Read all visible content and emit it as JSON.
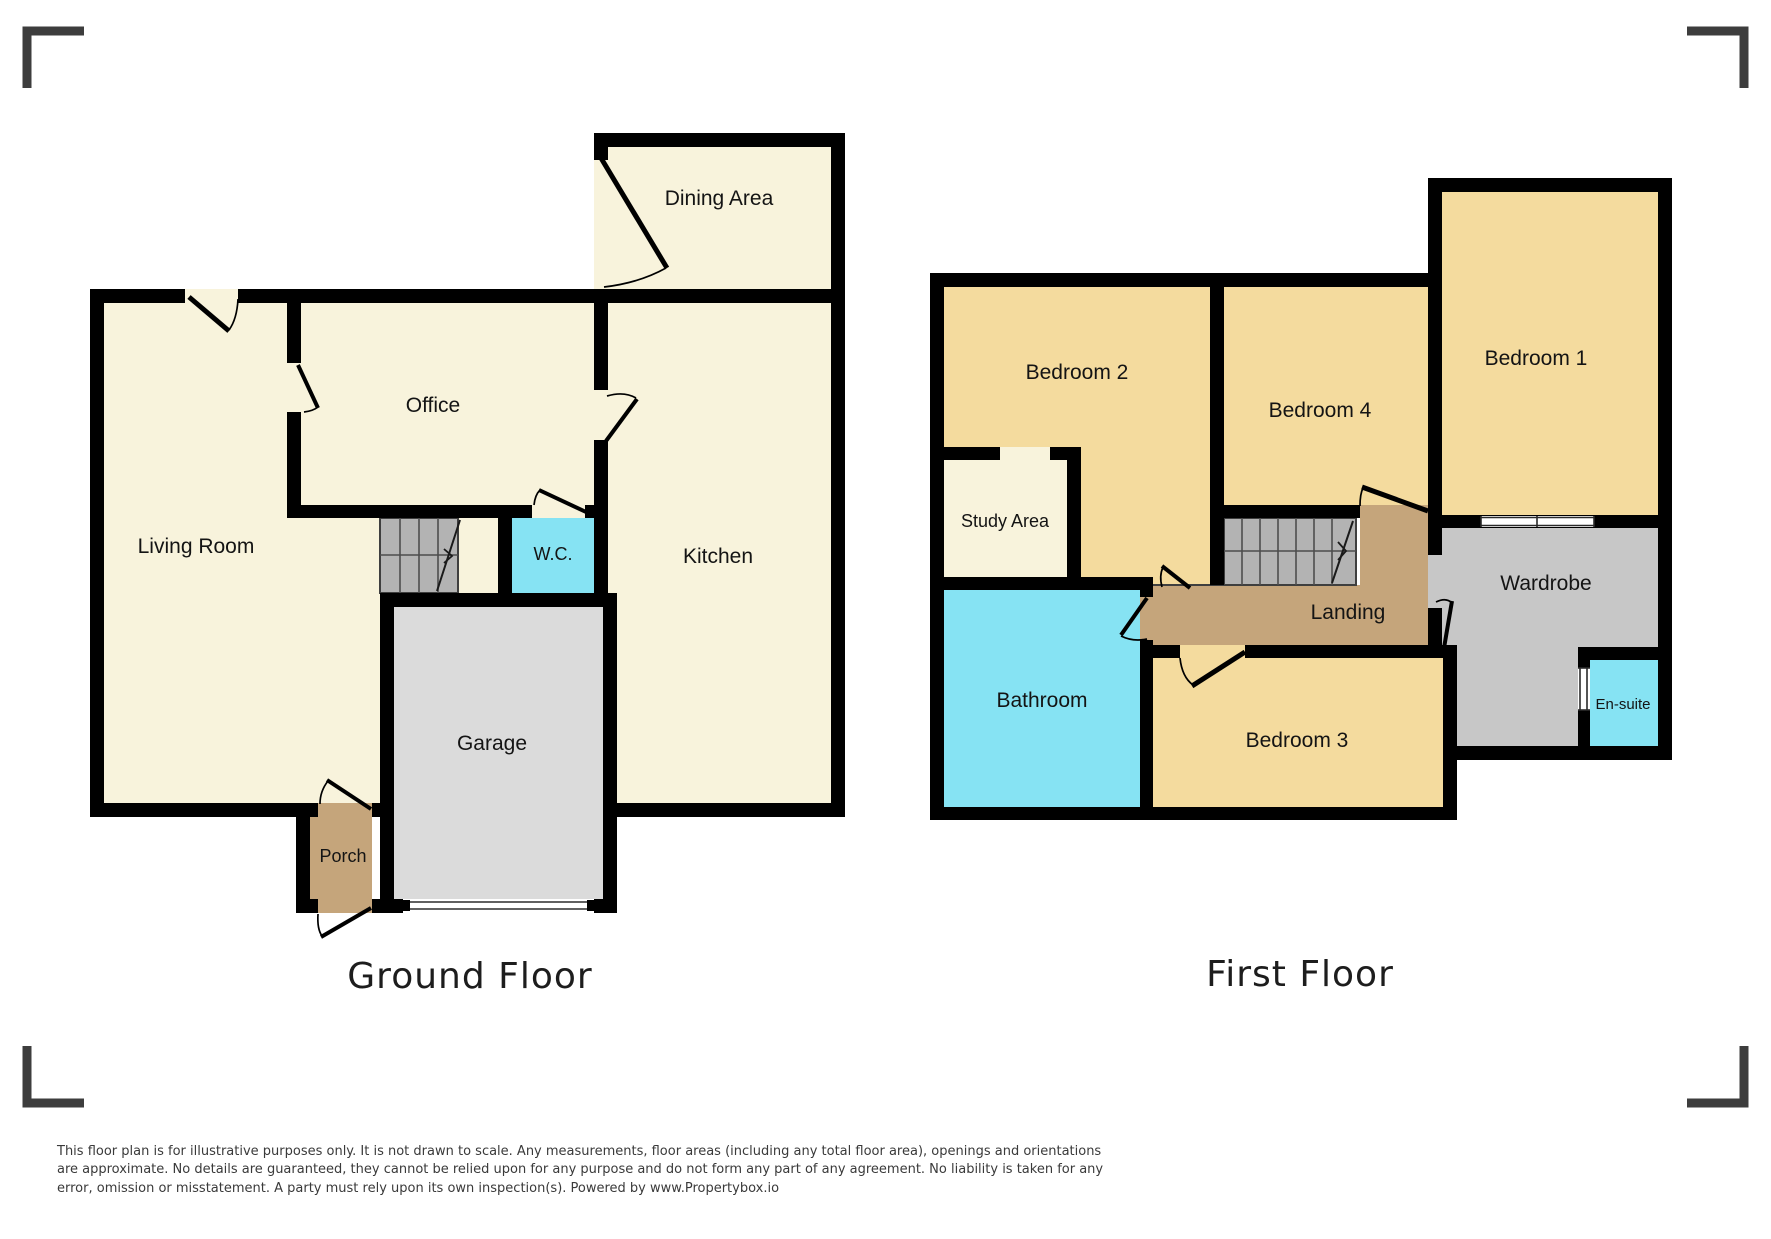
{
  "colors": {
    "cream": "#F8F3DC",
    "gold": "#F4DB9E",
    "cyan": "#86E3F3",
    "tan": "#C5A57B",
    "garage_gray": "#DBDBDB",
    "wardrobe_gray": "#C7C7C7",
    "stair_gray": "#B3B3B3",
    "wall": "#000000",
    "corner_mark": "#3d3d3d"
  },
  "floors": [
    {
      "id": "ground-floor",
      "title": "Ground Floor",
      "rooms": [
        {
          "id": "dining-area",
          "label": "Dining Area"
        },
        {
          "id": "office",
          "label": "Office"
        },
        {
          "id": "living-room",
          "label": "Living Room"
        },
        {
          "id": "kitchen",
          "label": "Kitchen"
        },
        {
          "id": "wc",
          "label": "W.C."
        },
        {
          "id": "garage",
          "label": "Garage"
        },
        {
          "id": "porch",
          "label": "Porch"
        }
      ]
    },
    {
      "id": "first-floor",
      "title": "First Floor",
      "rooms": [
        {
          "id": "bedroom-2",
          "label": "Bedroom 2"
        },
        {
          "id": "bedroom-4",
          "label": "Bedroom 4"
        },
        {
          "id": "bedroom-1",
          "label": "Bedroom 1"
        },
        {
          "id": "study-area",
          "label": "Study Area"
        },
        {
          "id": "bathroom",
          "label": "Bathroom"
        },
        {
          "id": "bedroom-3",
          "label": "Bedroom 3"
        },
        {
          "id": "landing",
          "label": "Landing"
        },
        {
          "id": "wardrobe",
          "label": "Wardrobe"
        },
        {
          "id": "en-suite",
          "label": "En-suite"
        }
      ]
    }
  ],
  "footer": {
    "disclaimer": "This floor plan is for illustrative purposes only. It is not drawn to scale. Any measurements, floor areas (including any total floor area), openings and orientations are approximate. No details are guaranteed, they cannot be relied upon for any purpose and do not form any part of any agreement. No liability is taken for any error, omission or misstatement. A party must rely upon its own inspection(s). Powered by www.Propertybox.io"
  }
}
